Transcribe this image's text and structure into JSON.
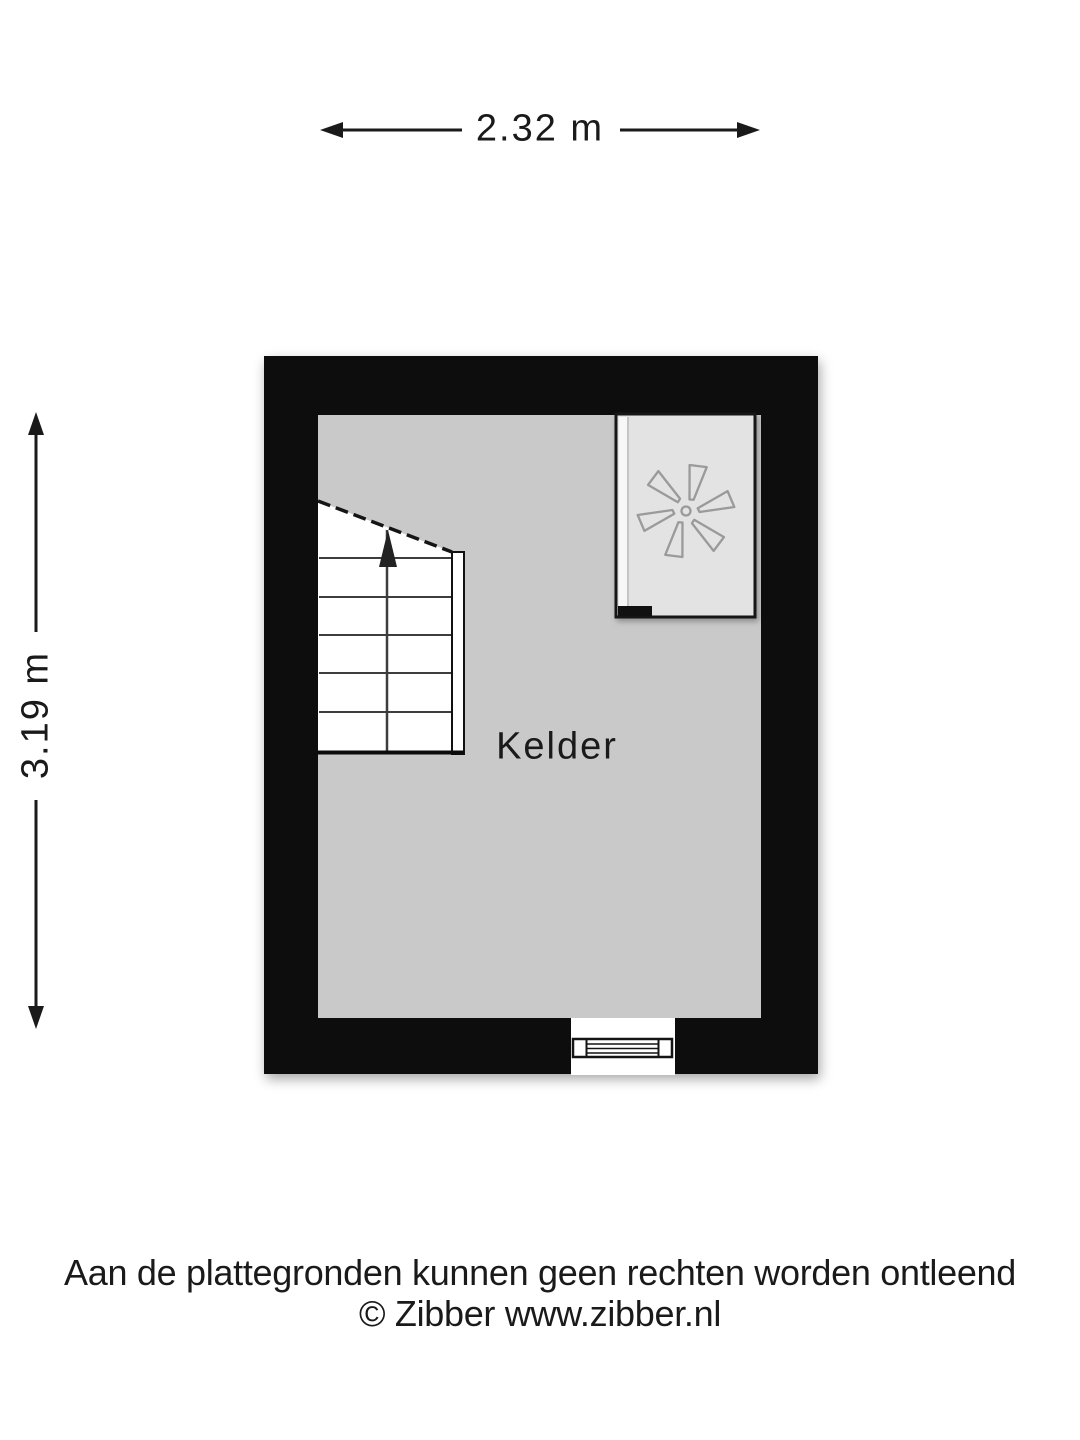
{
  "dimensions": {
    "width_label": "2.32 m",
    "height_label": "3.19 m"
  },
  "room": {
    "label": "Kelder"
  },
  "footer": {
    "disclaimer": "Aan de plattegronden kunnen geen rechten worden ontleend",
    "copyright": "© Zibber www.zibber.nl"
  },
  "icons": {
    "fan_icon": "six-blade-fan (boiler/ventilation unit symbol)",
    "stair_arrow_icon": "up-direction arrow",
    "dimension_arrow_icon": "double-headed measure arrow"
  },
  "colors": {
    "wall": "#0b0b0b",
    "floor": "#c9c9c9",
    "stairs": "#ffffff",
    "appliance_fill": "#e3e3e3",
    "fan_stroke": "#9a9a9a",
    "text": "#1a1a1a",
    "background": "#ffffff"
  }
}
